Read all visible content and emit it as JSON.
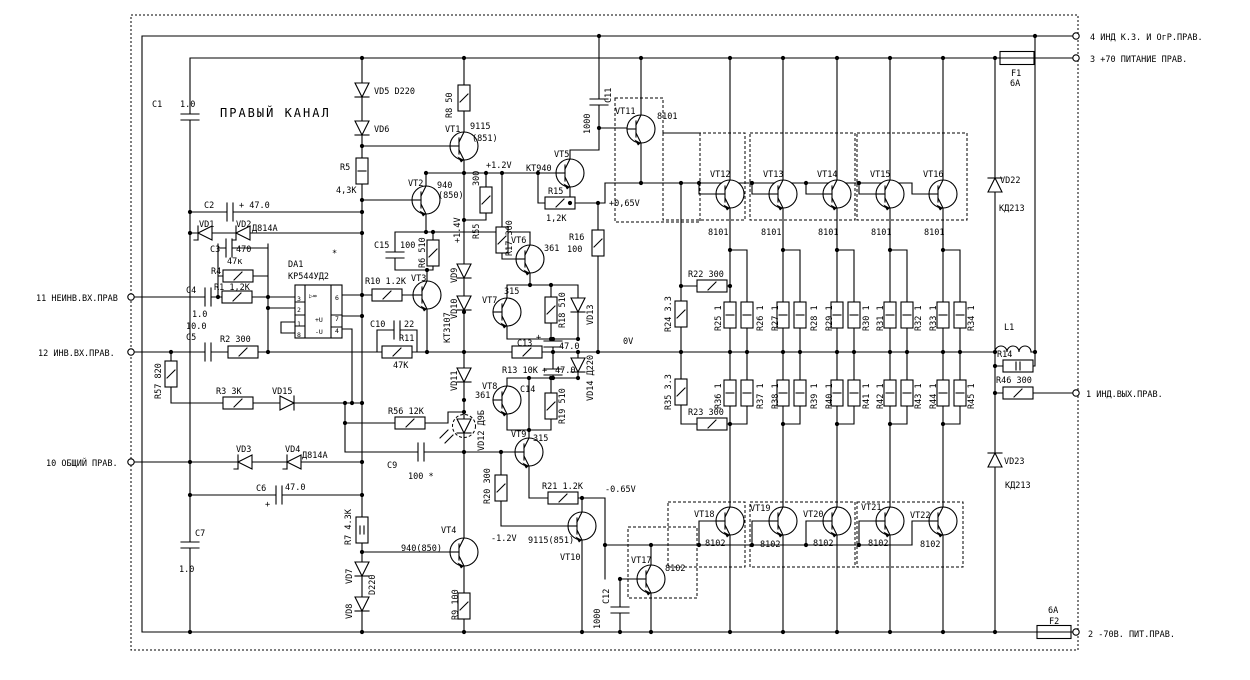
{
  "title": "ПРАВЫЙ КАНАЛ",
  "colors": {
    "ink": "#000000",
    "paper": "#ffffff"
  },
  "terminals": {
    "t11": "11 НЕИНВ.ВХ.ПРАВ",
    "t12": "12 ИНВ.ВХ.ПРАВ.",
    "t10": "10 ОБЩИЙ ПРАВ.",
    "t4": "4 ИНД К.З. И ОгР.ПРАВ.",
    "t3": "3 +70 ПИТАНИЕ ПРАВ.",
    "t1": "1 ИНД.ВЫХ.ПРАВ.",
    "t2": "2 -70В. ПИТ.ПРАВ."
  },
  "test_points": {
    "p12": "+1.2V",
    "p14": "+1.4V",
    "p065": "+0,65V",
    "zero": "0V",
    "m065": "-0.65V",
    "m12": "-1.2V"
  },
  "labels": {
    "c1": "C1",
    "c1v": "1.0",
    "c2": "C2",
    "c2v": "+ 47.0",
    "c3": "C3",
    "c3v": "470",
    "c4": "C4",
    "c4v": "1.0",
    "c5": "C5",
    "c5v": "10.0",
    "c6": "C6",
    "c6v": "47.0",
    "c6p": "+",
    "c7": "C7",
    "c7v": "1.0",
    "c9": "C9",
    "c9v": "100 *",
    "c10": "C10",
    "c10v": "22",
    "c11": "C11",
    "c11v": "1000",
    "c12": "C12",
    "c12v": "1000",
    "c13": "C13",
    "c13p": "+",
    "c13v": "47.0",
    "c14": "C14",
    "c14p": "+",
    "c14v": "47.0",
    "c15": "C15",
    "c15v": "100",
    "r1": "R1 1,2K",
    "r2": "R2 300",
    "r3": "R3 3К",
    "r4": "R4",
    "r4v": "47к",
    "r5": "R5",
    "r5v": "4,3К",
    "r6": "R6 510",
    "r7": "R7 4.3К",
    "r8": "R8 50",
    "r9": "R9 100",
    "r10": "R10 1.2K",
    "r11": "R11",
    "r11v": "47К",
    "r13": "R13 10К",
    "r14": "R14",
    "r15": "R15",
    "r15v": "1,2К",
    "r16": "R16",
    "r16v": "100",
    "r17": "R17 300",
    "r18": "R18 510",
    "r19": "R19 510",
    "r20": "R20 300",
    "r21": "R21 1.2К",
    "r22": "R22 300",
    "r23": "R23 300",
    "r24": "R24 3.3",
    "r35": "R35 3.3",
    "r25": "R25 1",
    "r26": "R26 1",
    "r27": "R27 1",
    "r28": "R28 1",
    "r29": "R29 1",
    "r30": "R30 1",
    "r31": "R31 1",
    "r32": "R32 1",
    "r33": "R33 1",
    "r34": "R34 1",
    "r36": "R36 1",
    "r37": "R37 1",
    "r38": "R38 1",
    "r39": "R39 1",
    "r40": "R40 1",
    "r41": "R41 1",
    "r42": "R42 1",
    "r43": "R43 1",
    "r44": "R44 1",
    "r45": "R45 1",
    "r46": "R46 300",
    "r55": "R55",
    "r55v": "300",
    "r56": "R56 12К",
    "r57": "R57 820",
    "l1": "L1",
    "f1": "F1",
    "f1v": "6А",
    "f2": "F2",
    "f2v": "6А",
    "da1": "DA1",
    "da1t": "КР544УД2",
    "p3": "3",
    "p2": "2",
    "p1": "1",
    "p8": "8",
    "p6": "6",
    "p7": "7",
    "p4": "4",
    "pu": "+U",
    "mu": "-U",
    "amp": "▷∞",
    "star": "*",
    "vt1": "VT1",
    "vt1a": "9115",
    "vt1b": "(851)",
    "vt2": "VT2",
    "vt2a": "940",
    "vt2b": "(850)",
    "vt3": "VT3",
    "vt3a": "КТ3107",
    "vt4": "VT4",
    "vt4a": "940(850)",
    "vt5": "VT5",
    "vt5a": "КТ940",
    "vt6": "VT6",
    "vt6a": "361",
    "vt7": "VT7",
    "vt7a": "315",
    "vt8": "VT8",
    "vt8a": "361",
    "vt9": "VT9",
    "vt9a": "315",
    "vt10": "VT10",
    "vt10a": "9115(851)",
    "vt11": "VT11",
    "vt11a": "8101",
    "vt12": "VT12",
    "vt12a": "8101",
    "vt13": "VT13",
    "vt13a": "8101",
    "vt14": "VT14",
    "vt14a": "8101",
    "vt15": "VT15",
    "vt15a": "8101",
    "vt16": "VT16",
    "vt16a": "8101",
    "vt17": "VT17",
    "vt17a": "8102",
    "vt18": "VT18",
    "vt18a": "8102",
    "vt19": "VT19",
    "vt19a": "8102",
    "vt20": "VT20",
    "vt20a": "8102",
    "vt21": "VT21",
    "vt21a": "8102",
    "vt22": "VT22",
    "vt22a": "8102",
    "vd1": "VD1",
    "vd2": "VD2",
    "zen1": "Д814А",
    "vd3": "VD3",
    "vd4": "VD4",
    "zen2": "Д814А",
    "vd5": "VD5 D220",
    "vd6": "VD6",
    "vd7": "VD7",
    "vd7a": "D220",
    "vd8": "VD8",
    "vd9": "VD9",
    "vd10": "VD10",
    "vd11": "VD11",
    "vd12": "VD12 Д9Б",
    "vd13": "VD13",
    "vd14": "VD14 Д220",
    "vd15": "VD15",
    "vd22": "VD22",
    "vd22a": "КД213",
    "vd23": "VD23",
    "vd23a": "КД213"
  }
}
